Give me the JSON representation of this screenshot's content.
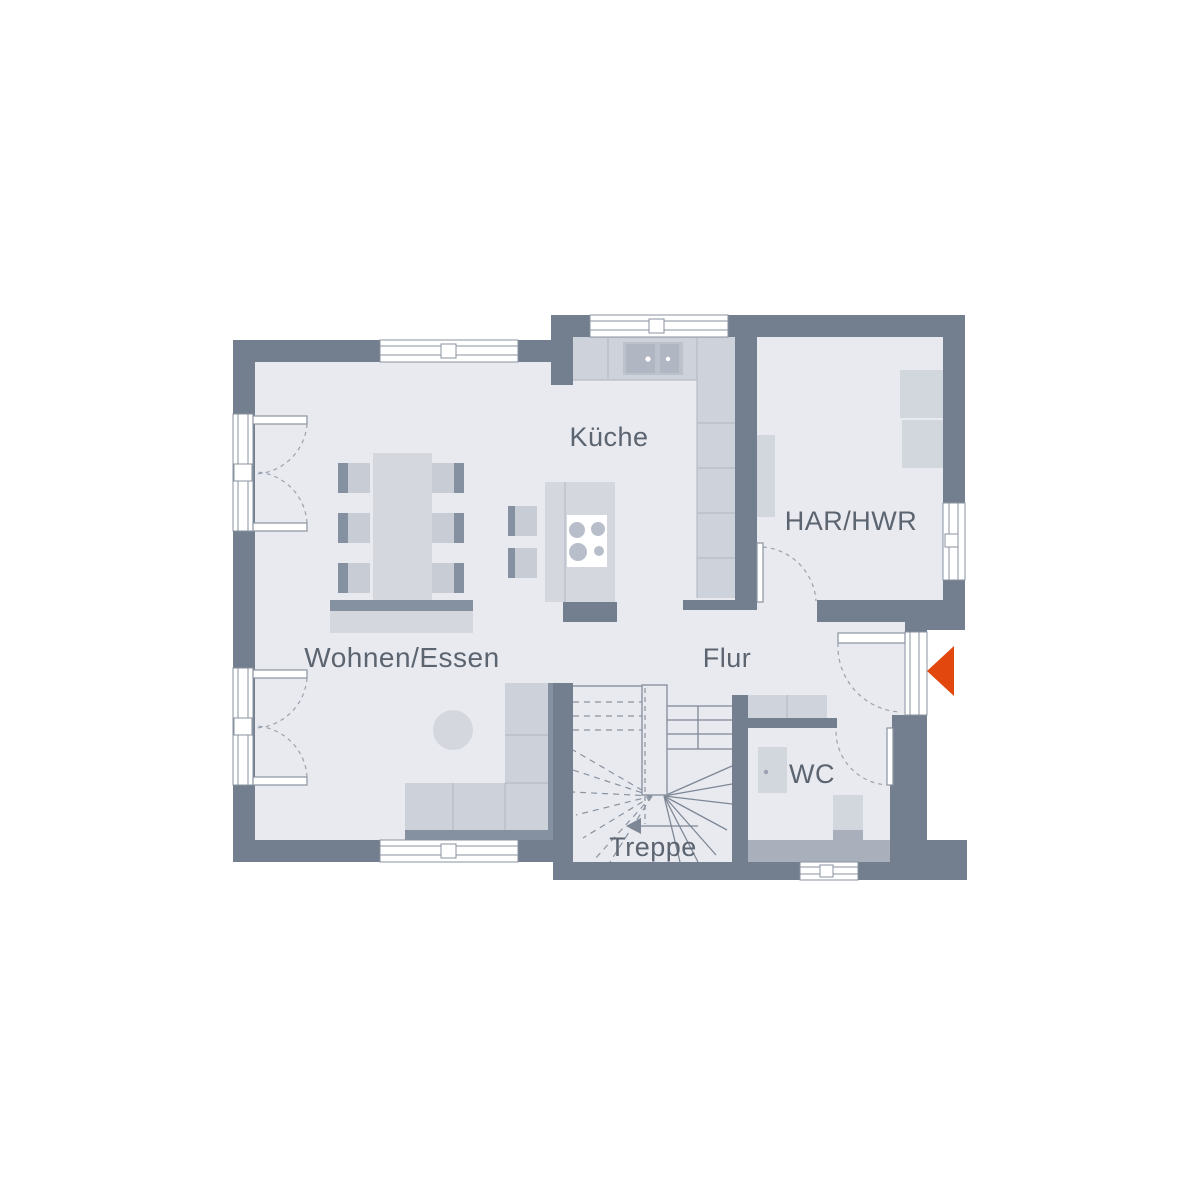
{
  "rooms": {
    "kueche": "Küche",
    "har_hwr": "HAR/HWR",
    "wohnen_essen": "Wohnen/Essen",
    "flur": "Flur",
    "wc": "WC",
    "treppe": "Treppe"
  },
  "colors": {
    "wall": "#737f8e",
    "floor": "#e8eaf0",
    "furn_light": "#d4d7de",
    "furn_mid": "#c7ccd5",
    "appliance": "#bcc2cc",
    "accent_bar": "#8591a0",
    "frame_line": "#8a93a0",
    "dash_line": "#9aa2ae",
    "label_text": "#5c6470",
    "entrance_arrow": "#e2470e"
  }
}
